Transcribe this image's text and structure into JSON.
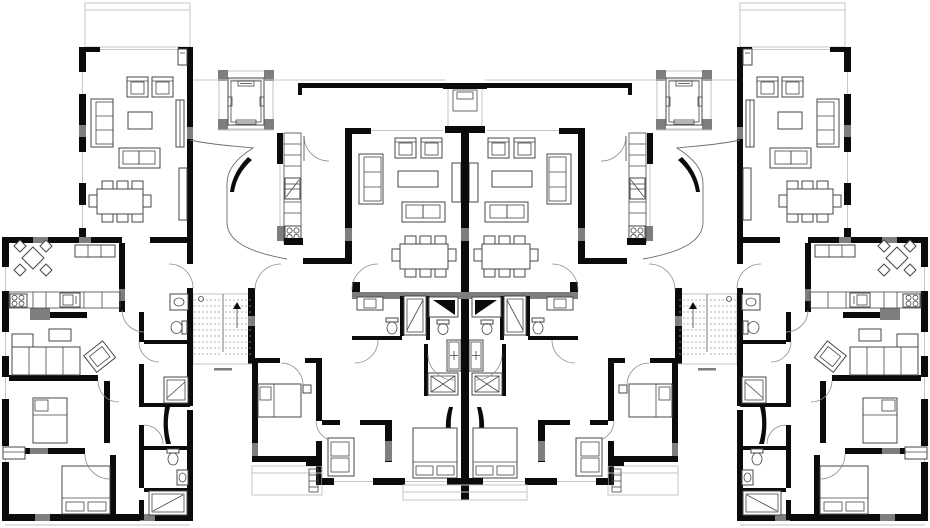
{
  "drawing": {
    "kind": "residential-floor-plan",
    "orientation": "mirror-symmetric",
    "visible_text": ""
  },
  "colors": {
    "wall": "#0b0b0b",
    "gray": "#7e7e7e",
    "light": "#c6c6c6",
    "line": "#474747",
    "dash": "#9a9a9a",
    "bg": "#ffffff"
  },
  "inventory": {
    "wings": [
      "balcony",
      "living-room",
      "armchair-pair",
      "three-seat-sofa",
      "coffee-table",
      "two-seat-sofa",
      "sideboards",
      "dining-table-eight-chairs",
      "wall-shelf"
    ],
    "core": [
      "elevator",
      "stair-flight-dashed-treads",
      "curved-hall-wall",
      "kitchen-cabinet-strip",
      "oven",
      "four-burner-stove",
      "vent-shaft"
    ],
    "central_units": [
      "living-room-pair",
      "dining-table-eight-chairs",
      "bathroom-stack",
      "vanity-sink",
      "toilet",
      "shower-cabin",
      "bathtub-glass-door",
      "washing-machine",
      "shower-tray",
      "double-bed",
      "two-seat-sofa",
      "wardrobe-wall"
    ],
    "outer_units": [
      "corner-dining-set-rotated",
      "kitchen-counter",
      "sink-unit",
      "l-shaped-sofa",
      "rotated-armchair",
      "single-bed",
      "double-bed",
      "bathroom-stack",
      "terrace",
      "radiator"
    ]
  }
}
